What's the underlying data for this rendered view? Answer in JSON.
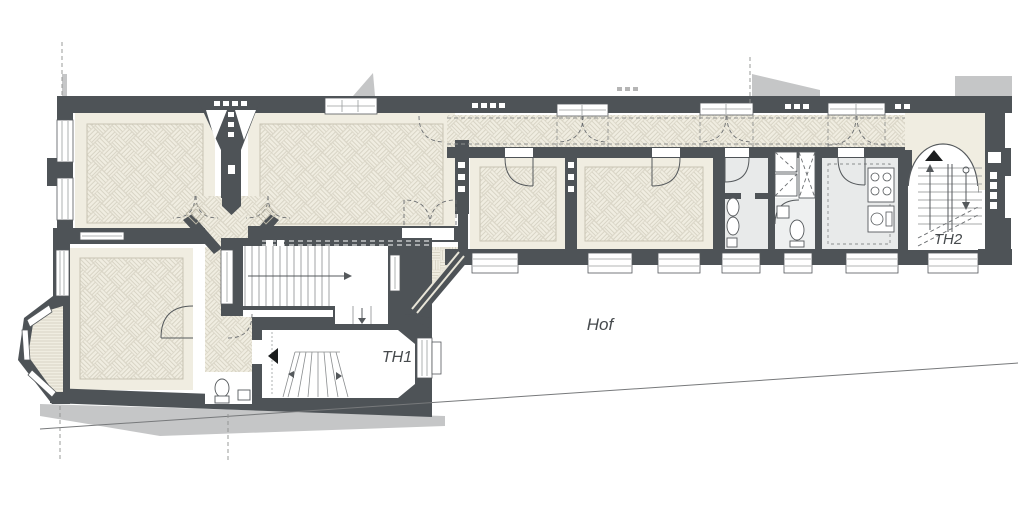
{
  "plan": {
    "type": "architectural floor plan, ground floor with courtyard",
    "labels": {
      "hof": "Hof",
      "th1": "TH1",
      "th2": "TH2"
    },
    "icons": [
      {
        "name": "entrance-arrow-left-icon",
        "glyph": "black triangle pointing left at TH1"
      },
      {
        "name": "entrance-arrow-up-icon",
        "glyph": "black triangle pointing up at TH2"
      }
    ],
    "colors": {
      "wall": "#4e5357",
      "parquetBg": "#f0ede1",
      "parquetLine": "#d8d4c5",
      "floorGray": "#e8eaea",
      "shadow": "#c5c6c7",
      "label": "#464a4d",
      "dash": "#8f918f",
      "boundary": "#6f7274",
      "paper": "#ffffff"
    }
  }
}
